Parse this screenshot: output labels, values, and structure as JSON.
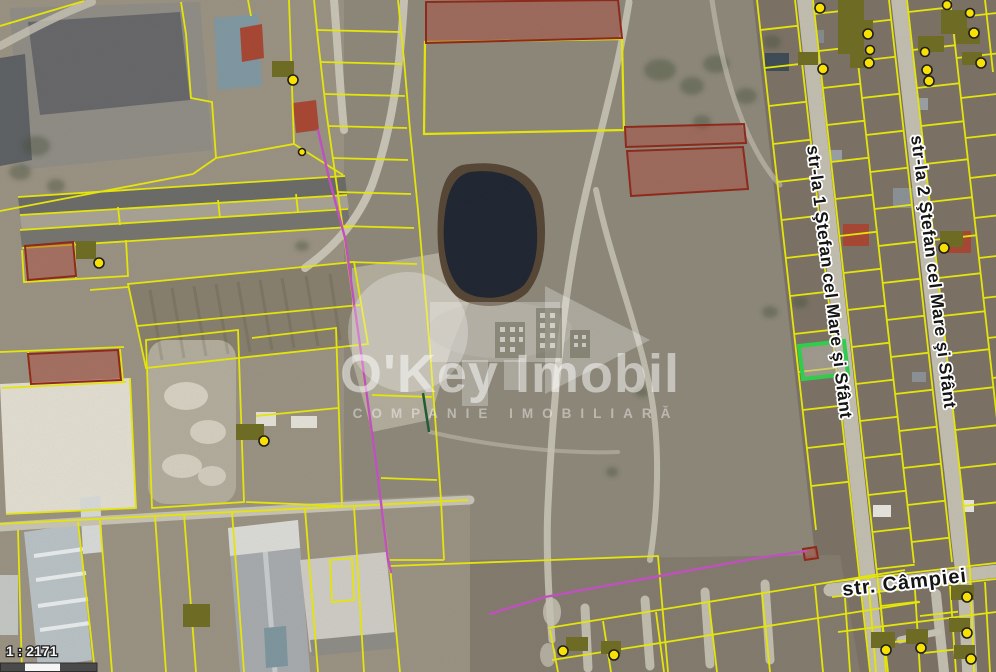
{
  "map_viewer": {
    "type": "satellite-cadastral-map",
    "scale": {
      "ratio_label": "1 : 2171"
    },
    "streets": [
      {
        "label": "str-la 1 Ştefan cel Mare şi Sfânt"
      },
      {
        "label": "str-la 2 Ştefan cel Mare şi Sfânt"
      },
      {
        "label": "str. Câmpiei"
      }
    ],
    "colors": {
      "parcel_line": "#eaea06",
      "selected_parcel": "#2fd14c",
      "offer_parcel_fill": "#b14538",
      "offer_parcel_stroke": "#8f2718",
      "boundary_magenta": "#c44fc4",
      "marker_dot": "#ffe600",
      "marker_blob": "#6e6b22"
    }
  },
  "watermark": {
    "title": "O'Key Imobil",
    "subtitle": "COMPANIE IMOBILIARĂ"
  }
}
